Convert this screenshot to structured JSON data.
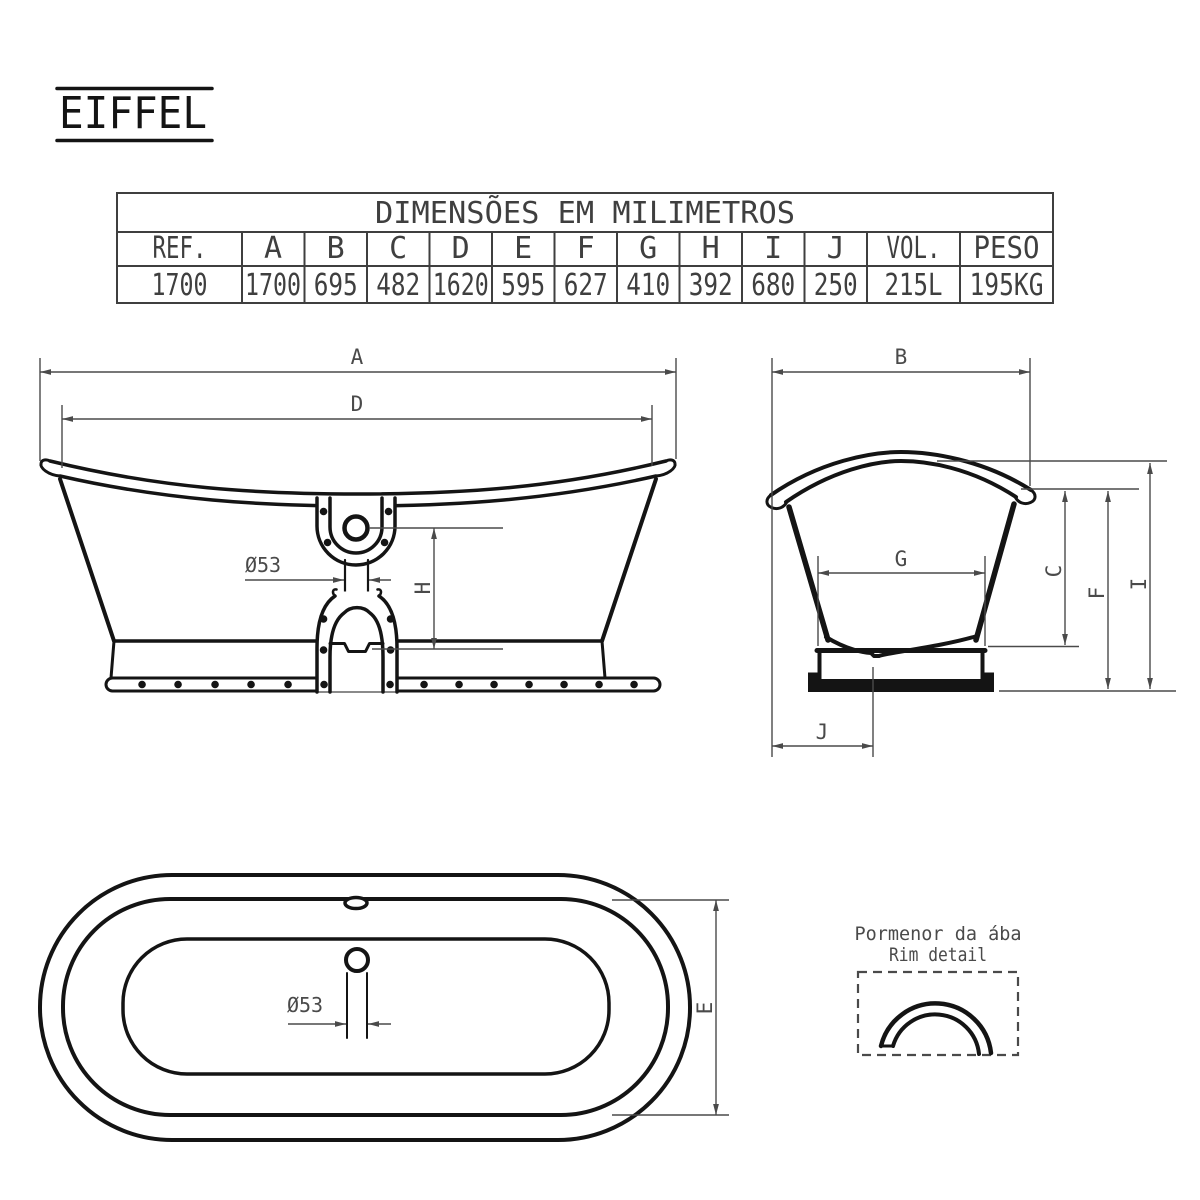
{
  "title": "EIFFEL",
  "table": {
    "header": "DIMENSÕES EM MILIMETROS",
    "columns": [
      "REF.",
      "A",
      "B",
      "C",
      "D",
      "E",
      "F",
      "G",
      "H",
      "I",
      "J",
      "VOL.",
      "PESO"
    ],
    "values": [
      "1700",
      "1700",
      "695",
      "482",
      "1620",
      "595",
      "627",
      "410",
      "392",
      "680",
      "250",
      "215L",
      "195KG"
    ]
  },
  "dims": {
    "A": "A",
    "B": "B",
    "C": "C",
    "D": "D",
    "E": "E",
    "F": "F",
    "G": "G",
    "H": "H",
    "I": "I",
    "J": "J",
    "drain_side": "Ø53",
    "drain_top": "Ø53"
  },
  "rim_detail": {
    "label_pt": "Pormenor da ába",
    "label_en": "Rim detail"
  },
  "colors": {
    "object_line": "#141414",
    "dimension_line": "#4a4a4a",
    "table_line": "#3f3f3f",
    "background": "#ffffff"
  }
}
